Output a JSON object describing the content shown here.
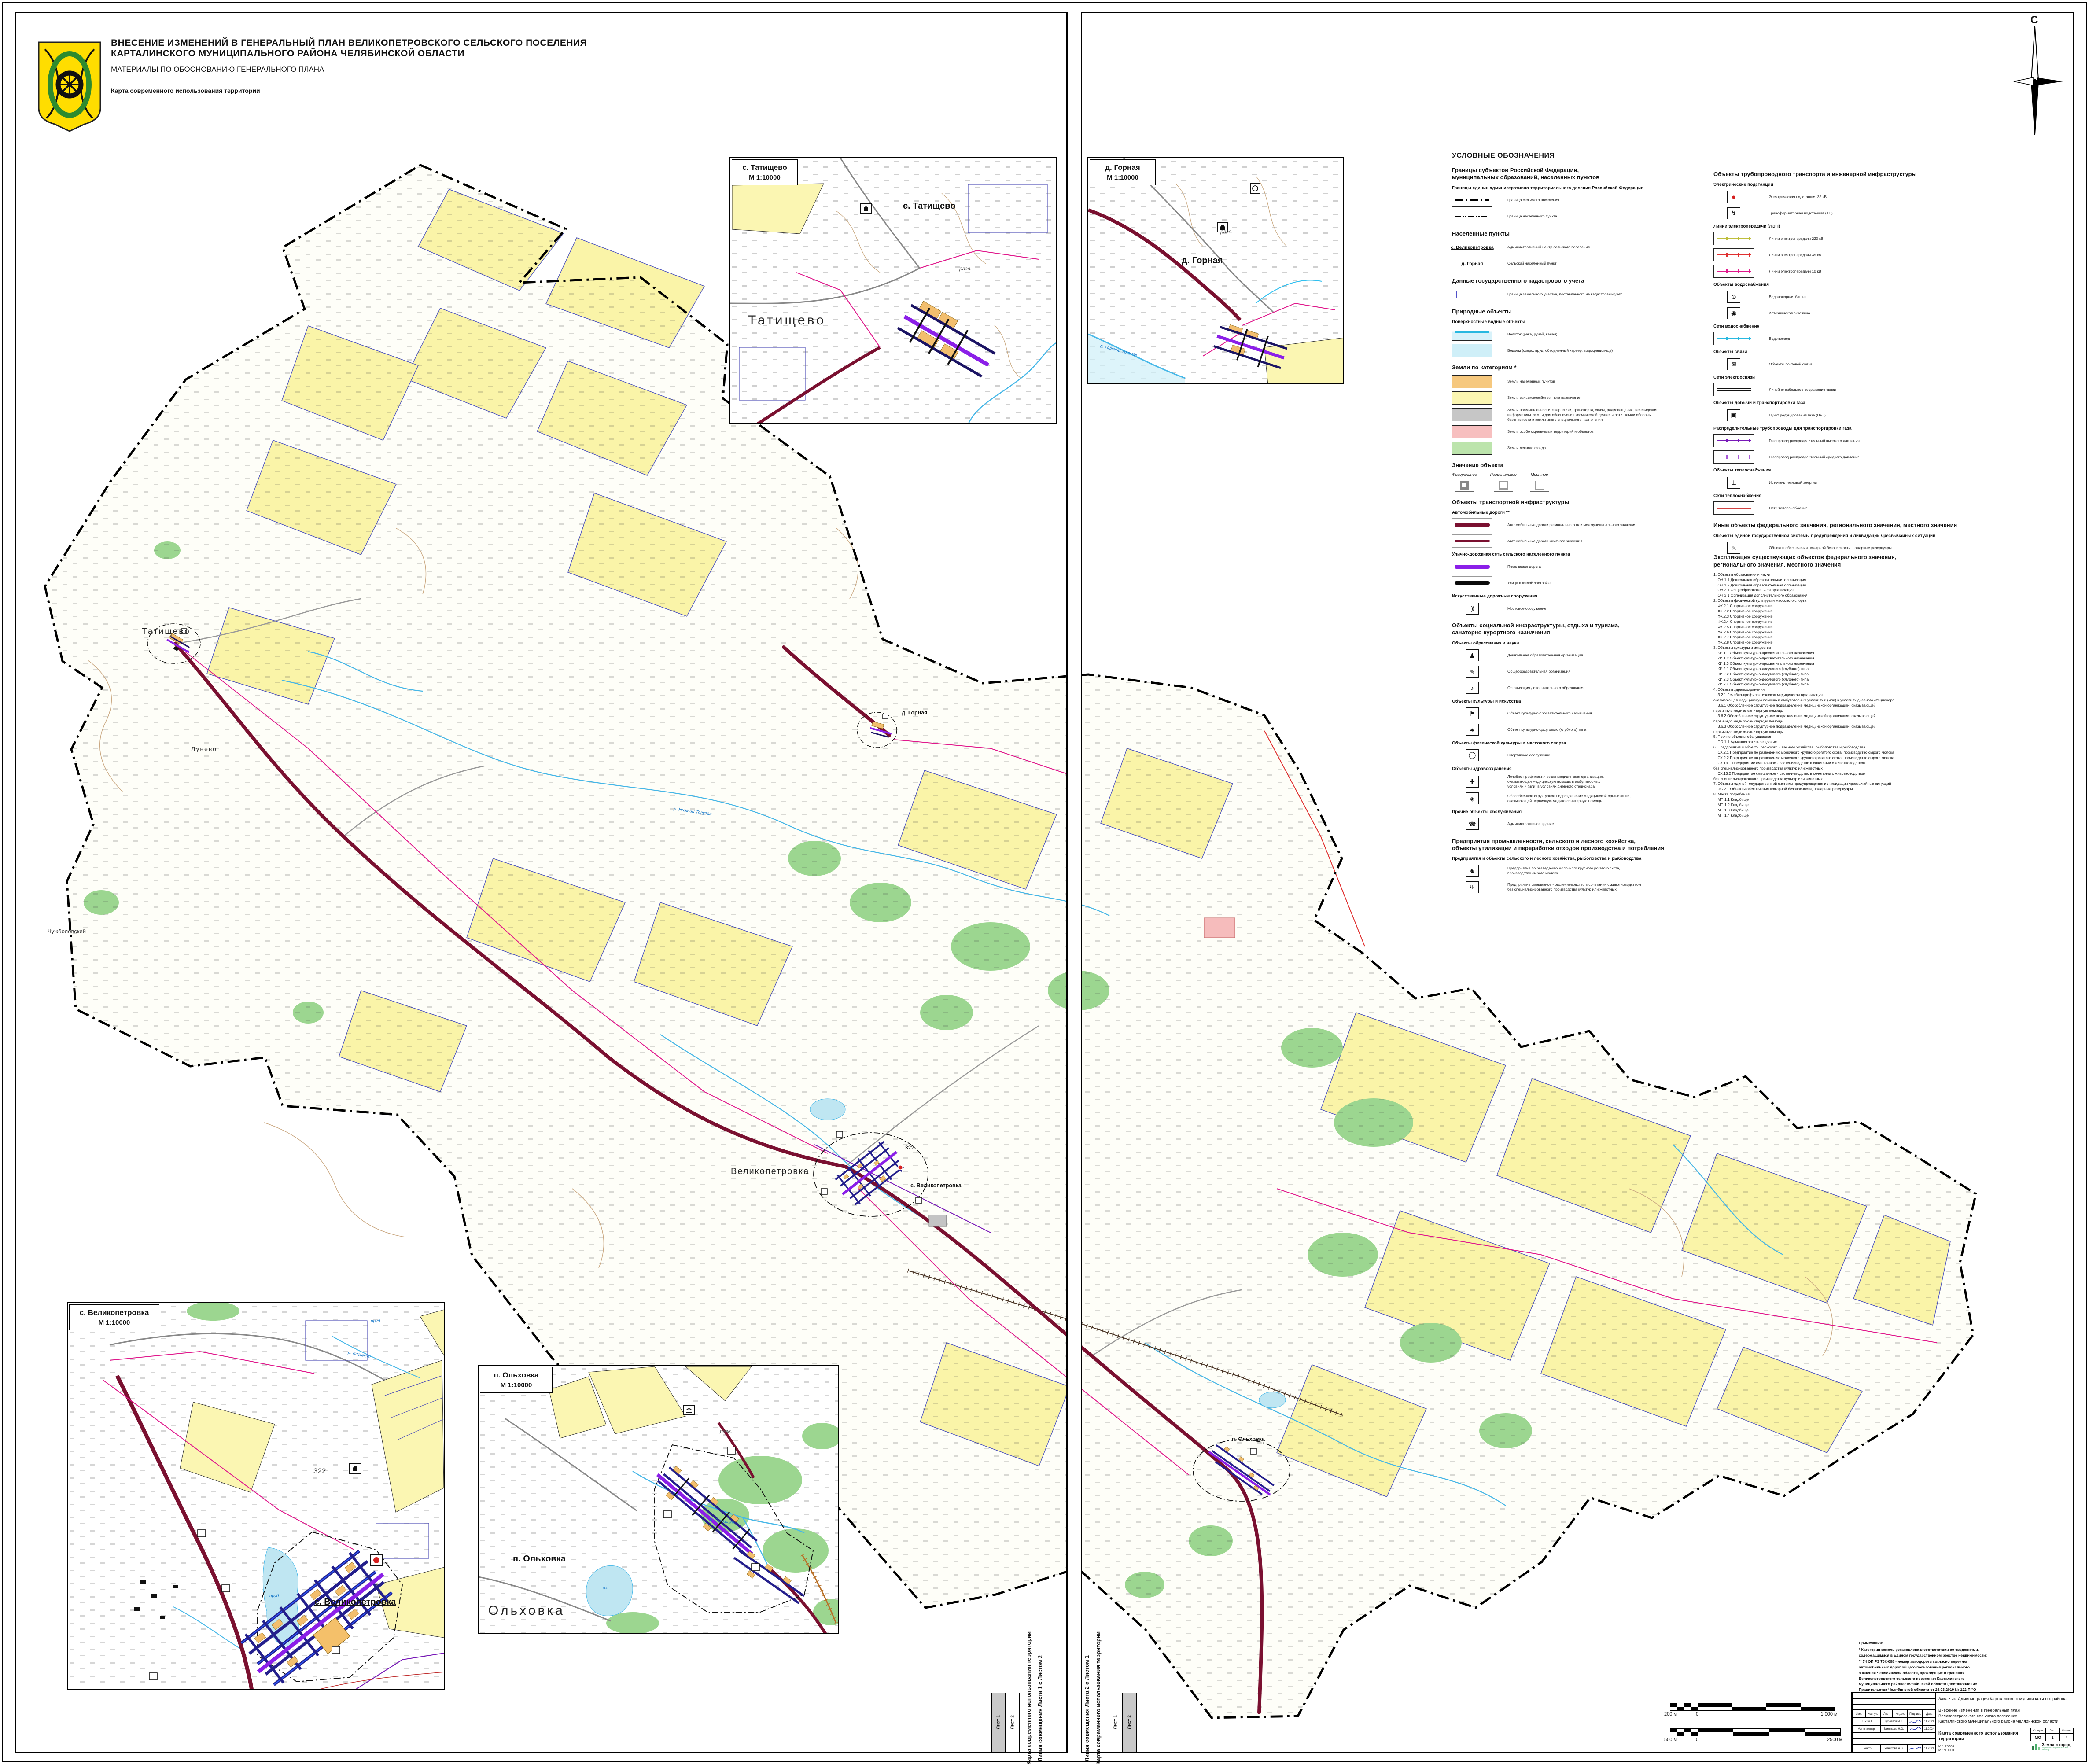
{
  "header": {
    "line1": "ВНЕСЕНИЕ ИЗМЕНЕНИЙ В ГЕНЕРАЛЬНЫЙ ПЛАН ВЕЛИКОПЕТРОВСКОГО СЕЛЬСКОГО ПОСЕЛЕНИЯ",
    "line2": "КАРТАЛИНСКОГО МУНИЦИПАЛЬНОГО РАЙОНА ЧЕЛЯБИНСКОЙ ОБЛАСТИ",
    "subtitle": "МАТЕРИАЛЫ ПО ОБОСНОВАНИЮ ГЕНЕРАЛЬНОГО ПЛАНА",
    "map_name": "Карта современного использования территории"
  },
  "compass": {
    "north": "С"
  },
  "insets": [
    {
      "title": "с. Татищево",
      "scale": "М 1:10000",
      "big_label": "Татищево",
      "village_label": "с. Татищево",
      "ruins": "разв."
    },
    {
      "title": "д. Горная",
      "scale": "М 1:10000",
      "village_label": "д. Горная",
      "ruins": "разв.",
      "river": "р. Нижний Тогузак"
    },
    {
      "title": "с. Великопетровка",
      "scale": "М 1:10000",
      "village_label": "с. Великопетровка",
      "river": "р. Кисинет",
      "pond1": "пруд",
      "pond2": "пруд",
      "elevation": "322"
    },
    {
      "title": "п. Ольховка",
      "scale": "М 1:10000",
      "big_label": "Ольховка",
      "village_label": "п. Ольховка",
      "ruins": "разв.",
      "lake": "оз.",
      "river": "р. Ольховка"
    }
  ],
  "main_map": {
    "labels": [
      {
        "text": "Татищево"
      },
      {
        "text": "Лунево"
      },
      {
        "text": "Чужболовский"
      },
      {
        "text": "Великопетровка"
      },
      {
        "text": "с. Великопетровка"
      },
      {
        "text": "д. Горная"
      },
      {
        "text": "п. Ольховка"
      },
      {
        "text": "322"
      },
      {
        "text": "р. Нижний Тогузак"
      }
    ]
  },
  "legend": {
    "title": "УСЛОВНЫЕ ОБОЗНАЧЕНИЯ",
    "left": [
      {
        "t": "h1",
        "text": "Границы субъектов Российской Федерации,\nмуниципальных образований, населенных пунктов"
      },
      {
        "t": "h2",
        "text": "Границы единиц административно-территориального деления Российской Федерации"
      },
      {
        "t": "item",
        "sw": "ln b-sp",
        "n": "boundary-settlement-swatch",
        "text": "Граница сельского поселения"
      },
      {
        "t": "item",
        "sw": "ln b-np",
        "n": "boundary-locality-swatch",
        "text": "Граница населенного пункта"
      },
      {
        "t": "h1",
        "text": "Населенные пункты"
      },
      {
        "t": "item",
        "sw": "nm nm-adm",
        "n": "admin-center-name",
        "sw_text": "с. Великопетровка",
        "text": "Административный центр сельского поселения"
      },
      {
        "t": "item",
        "sw": "nm",
        "n": "rural-locality-name",
        "sw_text": "д. Горная",
        "text": "Сельский населенный пункт"
      },
      {
        "t": "h1",
        "text": "Данные государственного кадастрового учета"
      },
      {
        "t": "item",
        "sw": "cad",
        "n": "cadastral-parcel-swatch",
        "text": "Граница земельного участка, поставленного на кадастровый учет"
      },
      {
        "t": "h1",
        "text": "Природные объекты"
      },
      {
        "t": "h2",
        "text": "Поверхностные водные объекты"
      },
      {
        "t": "item",
        "sw": "wstream",
        "n": "watercourse-swatch",
        "text": "Водоток (река, ручей, канал)"
      },
      {
        "t": "item",
        "sw": "wpond",
        "n": "waterbody-swatch",
        "text": "Водоем (озеро, пруд, обводненный карьер, водохранилище)"
      },
      {
        "t": "h1",
        "text": "Земли по категориям *"
      },
      {
        "t": "item",
        "sw": "fl f-o",
        "n": "settlement-lands-swatch",
        "text": "Земли населенных пунктов"
      },
      {
        "t": "item",
        "sw": "fl f-y",
        "n": "agricultural-lands-swatch",
        "text": "Земли сельскохозяйственного назначения"
      },
      {
        "t": "item",
        "sw": "fl f-g",
        "n": "industrial-lands-swatch",
        "text": "Земли промышленности, энергетики, транспорта, связи, радиовещания, телевидения,\nинформатики, земли для обеспечения космической деятельности, земли обороны,\nбезопасности и земли иного специального назначения"
      },
      {
        "t": "item",
        "sw": "fl f-p",
        "n": "protected-lands-swatch",
        "text": "Земли особо охраняемых территорий и объектов"
      },
      {
        "t": "item",
        "sw": "fl f-fr",
        "n": "forest-lands-swatch",
        "text": "Земли лесного фонда"
      },
      {
        "t": "h1",
        "text": "Значение объекта"
      },
      {
        "t": "sig",
        "items": [
          {
            "label": "Федеральное",
            "k": "sg-f"
          },
          {
            "label": "Региональное",
            "k": "sg-r"
          },
          {
            "label": "Местное",
            "k": "sg-m"
          }
        ]
      },
      {
        "t": "h1",
        "text": "Объекты транспортной инфраструктуры"
      },
      {
        "t": "h2",
        "text": "Автомобильные дороги **"
      },
      {
        "t": "item",
        "sw": "rd rd-r",
        "n": "regional-road-swatch",
        "text": "Автомобильные дороги регионального или межмуниципального значения"
      },
      {
        "t": "item",
        "sw": "rd rd-l",
        "n": "local-road-swatch",
        "text": "Автомобильные дороги местного значения"
      },
      {
        "t": "h2",
        "text": "Улично-дорожная сеть сельского населенного пункта"
      },
      {
        "t": "item",
        "sw": "rd rd-s",
        "n": "settlement-road-swatch",
        "text": "Поселковая дорога"
      },
      {
        "t": "item",
        "sw": "rd rd-u",
        "n": "residential-street-swatch",
        "text": "Улица в жилой застройке"
      },
      {
        "t": "h2",
        "text": "Искусственные дорожные сооружения"
      },
      {
        "t": "item",
        "sw": "br",
        "g": ")(",
        "n": "bridge-icon",
        "text": "Мостовое сооружение"
      },
      {
        "t": "h1",
        "text": "Объекты социальной инфраструктуры, отдыха и туризма,\nсанаторно-курортного назначения"
      },
      {
        "t": "h2",
        "text": "Объекты образования и науки"
      },
      {
        "t": "item",
        "sw": "ic",
        "g": "♟",
        "n": "kindergarten-icon",
        "text": "Дошкольная образовательная организация"
      },
      {
        "t": "item",
        "sw": "ic",
        "g": "✎",
        "n": "school-icon",
        "text": "Общеобразовательная организация"
      },
      {
        "t": "item",
        "sw": "ic",
        "g": "♪",
        "n": "music-note-icon",
        "text": "Организация дополнительного образования"
      },
      {
        "t": "h2",
        "text": "Объекты культуры и искусства"
      },
      {
        "t": "item",
        "sw": "ic",
        "g": "⚑",
        "n": "culture-icon",
        "text": "Объект культурно-просветительного назначения"
      },
      {
        "t": "item",
        "sw": "ic",
        "g": "♣",
        "n": "club-icon",
        "text": "Объект культурно-досугового (клубного) типа"
      },
      {
        "t": "h2",
        "text": "Объекты физической культуры и массового спорта"
      },
      {
        "t": "item",
        "sw": "ic sport",
        "g": "◯",
        "n": "stadium-icon",
        "text": "Спортивное сооружение"
      },
      {
        "t": "h2",
        "text": "Объекты здравоохранения"
      },
      {
        "t": "item",
        "sw": "ic",
        "g": "✚",
        "n": "medical-cross-icon",
        "text": "Лечебно-профилактическая медицинская организация,\nоказывающая медицинскую помощь в амбулаторных\nусловиях и (или) в условиях дневного стационара"
      },
      {
        "t": "item",
        "sw": "ic",
        "g": "◈",
        "n": "medical-unit-icon",
        "text": "Обособленное структурное подразделение медицинской организации,\nоказывающей первичную медико-санитарную помощь"
      },
      {
        "t": "h2",
        "text": "Прочие объекты обслуживания"
      },
      {
        "t": "item",
        "sw": "ic",
        "g": "☎",
        "n": "phone-icon",
        "text": "Административное здание"
      },
      {
        "t": "h1",
        "text": "Предприятия промышленности, сельского и лесного хозяйства,\nобъекты утилизации и переработки отходов производства и потребления"
      },
      {
        "t": "h2",
        "text": "Предприятия и объекты сельского и лесного хозяйства, рыболовства и рыбоводства"
      },
      {
        "t": "item",
        "sw": "ic",
        "g": "♞",
        "n": "cattle-farm-icon",
        "text": "Предприятие по разведению молочного крупного рогатого скота,\nпроизводство сырого молока"
      },
      {
        "t": "item",
        "sw": "ic",
        "g": "Ψ",
        "n": "mixed-farm-icon",
        "text": "Предприятие смешанное - растениеводство в сочетании с животноводством\nбез специализированного производства культур или животных"
      }
    ],
    "right": [
      {
        "t": "h1",
        "text": "Объекты трубопроводного транспорта и инженерной инфраструктуры"
      },
      {
        "t": "h2",
        "text": "Электрические подстанции"
      },
      {
        "t": "item",
        "sw": "ic sub35",
        "g": "●",
        "n": "substation-35kv-icon",
        "text": "Электрическая подстанция 35 кВ"
      },
      {
        "t": "item",
        "sw": "ic",
        "g": "↯",
        "n": "transformer-icon",
        "text": "Трансформаторная подстанция (ТП)"
      },
      {
        "t": "h2",
        "text": "Линии электропередачи (ЛЭП)"
      },
      {
        "t": "item",
        "sw": "lp lp220",
        "n": "power-line-220kv-swatch",
        "text": "Линии электропередачи 220 кВ"
      },
      {
        "t": "item",
        "sw": "lp lp35",
        "n": "power-line-35kv-swatch",
        "text": "Линии электропередачи 35 кВ"
      },
      {
        "t": "item",
        "sw": "lp lp10",
        "n": "power-line-10kv-swatch",
        "text": "Линии электропередачи 10 кВ"
      },
      {
        "t": "h2",
        "text": "Объекты водоснабжения"
      },
      {
        "t": "item",
        "sw": "ic",
        "g": "⊙",
        "n": "water-tower-icon",
        "text": "Водонапорная башня"
      },
      {
        "t": "item",
        "sw": "ic",
        "g": "◉",
        "n": "artesian-well-icon",
        "text": "Артезианская скважина"
      },
      {
        "t": "h2",
        "text": "Сети водоснабжения"
      },
      {
        "t": "item",
        "sw": "wpipe",
        "n": "water-pipe-swatch",
        "text": "Водопровод"
      },
      {
        "t": "h2",
        "text": "Объекты связи"
      },
      {
        "t": "item",
        "sw": "ic",
        "g": "✉",
        "n": "post-office-icon",
        "text": "Объекты почтовой связи"
      },
      {
        "t": "h2",
        "text": "Сети электросвязи"
      },
      {
        "t": "item",
        "sw": "comm",
        "n": "telecom-line-swatch",
        "text": "Линейно-кабельное сооружение связи"
      },
      {
        "t": "h2",
        "text": "Объекты добычи и транспортировки газа"
      },
      {
        "t": "item",
        "sw": "ic",
        "g": "▣",
        "n": "gas-point-icon",
        "text": "Пункт редуцирования газа (ПРГ)"
      },
      {
        "t": "h2",
        "text": "Распределительные трубопроводы для транспортировки газа"
      },
      {
        "t": "item",
        "sw": "gas gas-h",
        "n": "gas-high-pressure-swatch",
        "text": "Газопровод распределительный высокого давления"
      },
      {
        "t": "item",
        "sw": "gas gas-m",
        "n": "gas-medium-pressure-swatch",
        "text": "Газопровод распределительный среднего давления"
      },
      {
        "t": "h2",
        "text": "Объекты теплоснабжения"
      },
      {
        "t": "item",
        "sw": "ic",
        "g": "⊥",
        "n": "heat-source-icon",
        "text": "Источник тепловой энергии"
      },
      {
        "t": "h2",
        "text": "Сети теплоснабжения"
      },
      {
        "t": "item",
        "sw": "heat",
        "n": "heat-network-swatch",
        "text": "Сети теплоснабжения"
      },
      {
        "t": "h1",
        "text": "Иные объекты федерального значения, регионального значения, местного значения"
      },
      {
        "t": "h2",
        "text": "Объекты единой государственной системы предупреждения и ликвидации чрезвычайных ситуаций"
      },
      {
        "t": "item",
        "sw": "ic",
        "g": "♨",
        "n": "fire-safety-icon",
        "text": "Объекты обеспечения пожарной безопасности, пожарные резервуары"
      },
      {
        "t": "h2",
        "text": "Места погребения"
      },
      {
        "t": "item",
        "sw": "ic",
        "g": "Ω",
        "n": "cemetery-icon",
        "text": "Кладбище"
      }
    ]
  },
  "explication": {
    "title": "Экспликация существующих объектов федерального значения,\nрегионального значения, местного значения",
    "lines": [
      "1. Объекты образования и науки",
      "    ОН.1.1 Дошкольная образовательная организация",
      "    ОН.1.2 Дошкольная образовательная организация",
      "    ОН.2.1 Общеобразовательная организация",
      "    ОН.3.1 Организация дополнительного образования",
      "2. Объекты физической культуры и массового спорта",
      "    ФК.2.1 Спортивное сооружение",
      "    ФК.2.2 Спортивное сооружение",
      "    ФК.2.3 Спортивное сооружение",
      "    ФК.2.4 Спортивное сооружение",
      "    ФК.2.5 Спортивное сооружение",
      "    ФК.2.6 Спортивное сооружение",
      "    ФК.2.7 Спортивное сооружение",
      "    ФК.2.8 Спортивное сооружение",
      "3. Объекты культуры и искусства",
      "    КИ.1.1 Объект культурно-просветительного назначения",
      "    КИ.1.2 Объект культурно-просветительного назначения",
      "    КИ.1.3 Объект культурно-просветительного назначения",
      "    КИ.2.1 Объект культурно-досугового (клубного) типа",
      "    КИ.2.2 Объект культурно-досугового (клубного) типа",
      "    КИ.2.3 Объект культурно-досугового (клубного) типа",
      "    КИ.2.4 Объект культурно-досугового (клубного) типа",
      "4. Объекты здравоохранения",
      "    З.2.1 Лечебно-профилактическая медицинская организация,",
      "оказывающая медицинскую помощь в амбулаторных условиях и (или) в условиях дневного стационара",
      "    З.6.1 Обособленное структурное подразделение медицинской организации, оказывающей",
      "первичную медико-санитарную помощь",
      "    З.6.2 Обособленное структурное подразделение медицинской организации, оказывающей",
      "первичную медико-санитарную помощь",
      "    З.6.3 Обособленное структурное подразделение медицинской организации, оказывающей",
      "первичную медико-санитарную помощь",
      "5. Прочие объекты обслуживания",
      "    ПО.1.1 Административное здание",
      "6. Предприятия и объекты сельского и лесного хозяйства, рыболовства и рыбоводства",
      "    СХ.2.1 Предприятие по разведению молочного крупного рогатого скота, производство сырого молока",
      "    СХ.2.2 Предприятие по разведению молочного крупного рогатого скота, производство сырого молока",
      "    СХ.13.1 Предприятие смешанное - растениеводство в сочетании с животноводством",
      "без специализированного производства культур или животных",
      "    СХ.13.2 Предприятие смешанное - растениеводство в сочетании с животноводством",
      "без специализированного производства культур или животных",
      "7. Объекты единой государственной системы предупреждения и ликвидации чрезвычайных ситуаций",
      "    ЧС.2.1 Объекты обеспечения пожарной безопасности, пожарные резервуары",
      "8. Места погребения",
      "    МП.1.1 Кладбище",
      "    МП.1.2 Кладбище",
      "    МП.1.3 Кладбище",
      "    МП.1.4 Кладбище"
    ]
  },
  "notes": {
    "title": "Примечания:",
    "p1": "* Категория земель установлена в соответствии со сведениями, содержащимися в Едином государственном реестре недвижимости;",
    "p2": "** 74 ОП РЗ 75К-098 - номер автодороги согласно перечню автомобильных дорог общего пользования регионального значения Челябинской области, проходящих в границах Великопетровского сельского поселения Карталинского муниципального района Челябинской области (постановление Правительства Челябинской области от 26.03.2019 № 122-П \"О Перечне областных автомобильных дорог общего пользования регионального или межмуниципального значения, являющихся собственностью Челябинской области по состоянию на 1 января 2019 года\")."
  },
  "title_block": {
    "customer": "Заказчик: Администрация Карталинского муниципального района",
    "project": "Внесение изменений в генеральный план\nВеликопетровского сельского поселения\nКарталинского муниципального района Челябинской области",
    "cols": [
      "Изм.",
      "Кол. уч.",
      "Лист",
      "№ док.",
      "Подпись",
      "Дата"
    ],
    "rows": [
      {
        "role": "НПУ №1",
        "name": "Курбатов И.В.",
        "date": "11.2024"
      },
      {
        "role": "Мл. инженер",
        "name": "Милякова Н.О.",
        "date": "11.2024"
      },
      {
        "role": "Н. контр.",
        "name": "Умнихова А.В.",
        "date": "11.2024"
      }
    ],
    "doc_title": "Карта современного использования\nтерритории",
    "stage_label": "Стадия",
    "sheet_label": "Лист",
    "sheets_label": "Листов",
    "stage": "МО",
    "sheet": "1",
    "sheets": "4",
    "scales": "М 1:25000\nМ 1:10000",
    "org": "Земля и город",
    "org_sub": "научно-исследовательский\nинститут"
  },
  "scale_bars": [
    {
      "left": "200 м",
      "zero": "0",
      "right": "1 000 м"
    },
    {
      "left": "500 м",
      "zero": "0",
      "right": "2500 м"
    }
  ],
  "sheet_join": {
    "map_label": "Карта современного использования территории",
    "join1": "Линия совмещения Листа 1 с Листом 2",
    "join2": "Линия совмещения Листа 2 с Листом 1",
    "sheet1": "Лист 1",
    "sheet2": "Лист 2"
  }
}
